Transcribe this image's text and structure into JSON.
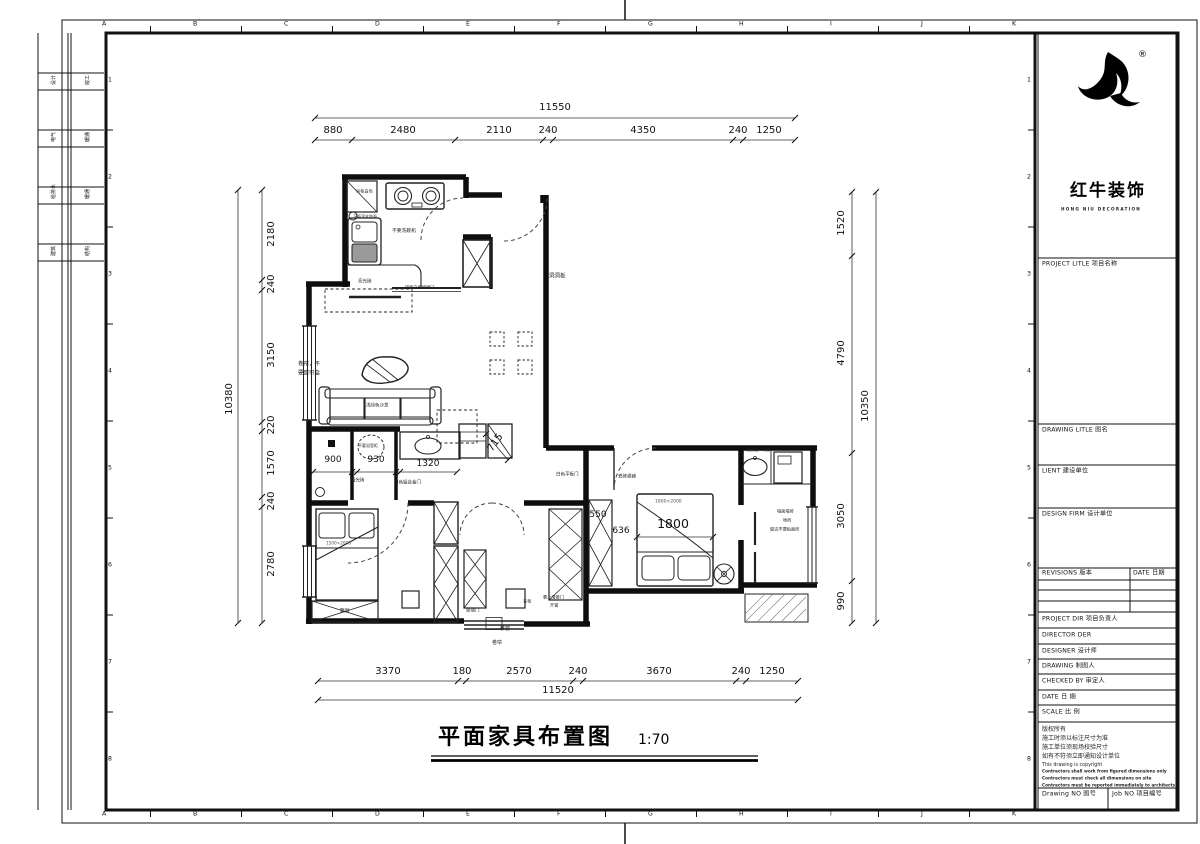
{
  "sheet": {
    "rulers": {
      "letters": [
        "A",
        "B",
        "C",
        "D",
        "E",
        "F",
        "G",
        "H",
        "I",
        "J",
        "K"
      ],
      "numbers": [
        "1",
        "2",
        "3",
        "4",
        "5",
        "6",
        "7",
        "8"
      ]
    },
    "stamps": [
      [
        "设计",
        "竣工"
      ],
      [
        "电气",
        "暖通"
      ],
      [
        "给排水",
        "暖通"
      ],
      [
        "建筑",
        "结构"
      ]
    ],
    "logo": {
      "reg": "®",
      "brand": "红牛装饰",
      "sub": "HONG NIU DECORATION"
    },
    "title_block": {
      "project": "PROJECT LITLE  项目名称",
      "drawing_title": "DRAWING LITLE  图名",
      "client": "LIENT  建设单位",
      "design_firm": "DESIGN FIRM  设计单位",
      "revisions": "REVISIONS  版本",
      "date_col": "DATE  日期",
      "project_dir": "PROJECT DIR   项目负责人",
      "director": "DIRECTOR DER",
      "designer": "DESIGNER      设计师",
      "drawing_by": "DRAWING      制图人",
      "checked_by": "CHECKED BY   审定人",
      "date": "DATE             日  期",
      "scale": "SCALE           比  例",
      "notes_cn": [
        "版权所有",
        "施工时须以标注尺寸为准",
        "施工单位须现场校验尺寸",
        "如有不符须立即通知设计单位"
      ],
      "notes_en": [
        "This drawing is copyright",
        "Contractors shall work from figured dimensions only",
        "Contractors must check all dimensions on site",
        "Contractors must be reported immediately to architects"
      ],
      "drawing_no": "Drawing NO  图号",
      "job_no": "Job NO  项目编号"
    }
  },
  "plan": {
    "title": "平面家具布置图",
    "scale": "1:70",
    "dims": {
      "top": {
        "total": "11550",
        "segments": [
          "880",
          "2480",
          "2110",
          "240",
          "4350",
          "240",
          "1250"
        ]
      },
      "bottom": {
        "total": "11520",
        "segments": [
          "3370",
          "180",
          "2570",
          "240",
          "3670",
          "240",
          "1250"
        ]
      },
      "left": {
        "total": "10380",
        "segments": [
          "2180",
          "240",
          "3150",
          "220",
          "1570",
          "240",
          "2780"
        ]
      },
      "right": {
        "total": "10350",
        "segments": [
          "1520",
          "4790",
          "3050",
          "990"
        ]
      },
      "interior": {
        "toilet": "900",
        "shower": "930",
        "vanity": "1320",
        "hall": "715",
        "wardrobe": "550",
        "gap": "636",
        "bed_width": "1800",
        "bed_size": "1800×2000",
        "bed2_size": "1500×2000"
      }
    },
    "labels": {
      "kitchen_cabinet": "吊柜白色",
      "kitchen_wood": "下面顶木饰面",
      "kitchen_no_dishwasher": "不要洗碗机",
      "kitchen_tile": "亮光砖",
      "kitchen_glass_door": "墙砖白色玻璃门",
      "no_curtain_line1": "卷帘，不",
      "no_curtain_line2": "要窗帘盒",
      "sofa": "浅绿色沙发",
      "pegboard": "洞洞板",
      "matte_tile": "哑光砖",
      "alu_door": "白色铝合金门",
      "no_bath_cabinet": "不要浴室柜",
      "white_flat_door": "白色平板门",
      "tiles_throughout": "瓷砖通铺",
      "window_height": "注意窗户高度",
      "bath_wall_tile": "墙面墙砖",
      "bath_floor_tile": "地砖",
      "bath_no_tile": "窗边不要贴面砖",
      "bay_window": "飘窗",
      "glass_door": "玻璃门",
      "wardrobe": "衣柜",
      "sliding_door": "靠上滑推门",
      "open_window": "开窗",
      "sliding_window": "移窗",
      "roller_blind": "卷帘"
    }
  }
}
